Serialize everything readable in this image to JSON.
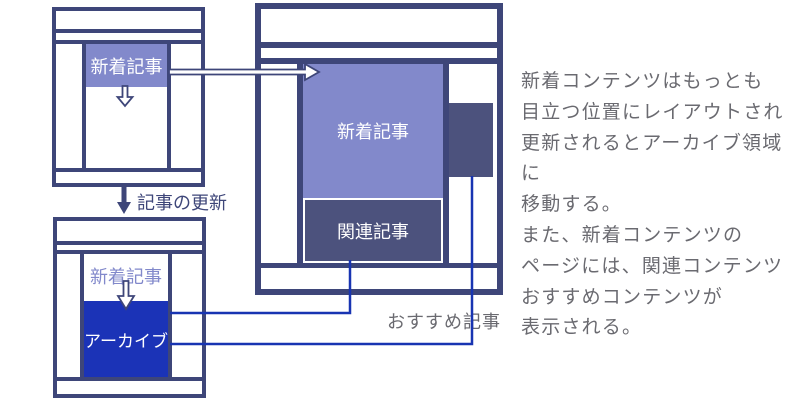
{
  "wireframes": {
    "before": {
      "new_label": "新着記事"
    },
    "after": {
      "new_label": "新着記事",
      "archive_label": "アーカイブ"
    },
    "featured": {
      "new_label": "新着記事",
      "related_label": "関連記事"
    }
  },
  "labels": {
    "update_arrow": "記事の更新",
    "recommend": "おすすめ記事"
  },
  "description_lines": [
    "新着コンテンツはもっとも",
    "目立つ位置にレイアウトされ",
    "更新されるとアーカイブ領域に",
    "移動する。",
    "また、新着コンテンツの",
    "ページには、関連コンテンツ",
    "おすすめコンテンツが",
    "表示される。"
  ],
  "colors": {
    "navy_border": "#3E4679",
    "periwinkle_box": "#8289CB",
    "slate_box": "#4C527D",
    "archive_blue": "#1B33B7",
    "connector_blue": "#1834B2",
    "text_gray": "#6A6A70"
  }
}
